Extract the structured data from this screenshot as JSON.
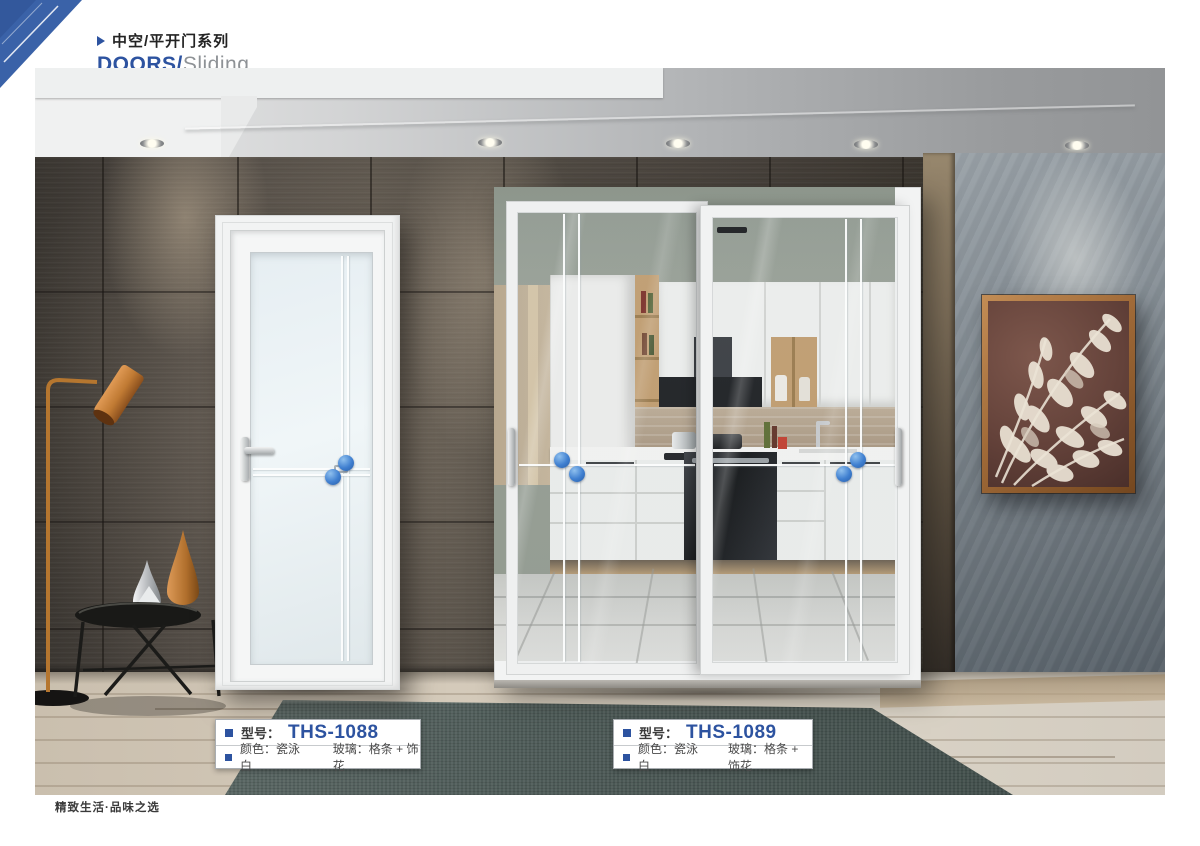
{
  "header": {
    "series_label": "中空/平开门系列",
    "title_primary": "DOORS/",
    "title_secondary": "Sliding"
  },
  "products": [
    {
      "model_label": "型号：",
      "model": "THS-1088",
      "color_spec": "颜色：瓷泳白",
      "glass_spec": "玻璃：格条 + 饰花"
    },
    {
      "model_label": "型号：",
      "model": "THS-1089",
      "color_spec": "颜色：瓷泳白",
      "glass_spec": "玻璃：格条 + 饰花"
    }
  ],
  "footer": {
    "tagline": "精致生活·品味之选"
  },
  "colors": {
    "accent_blue": "#2d53a0",
    "logo_blue": "#3a62a8",
    "ornament_blue": "#3f7fd0",
    "rug_teal": "#4e5b58",
    "frame_white": "#f2f3f3"
  }
}
